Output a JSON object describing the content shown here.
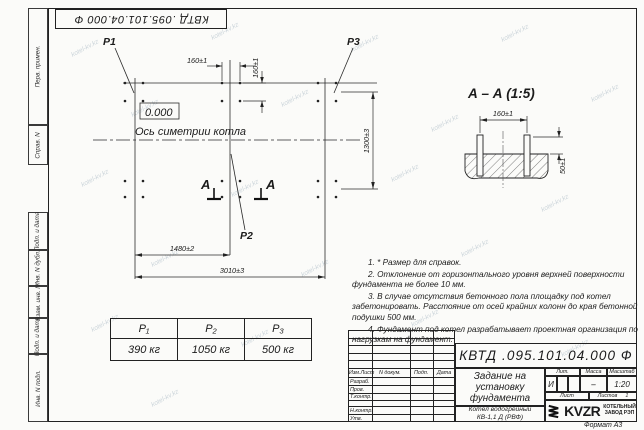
{
  "watermark": {
    "text": "kotel-kv.kz"
  },
  "frame": {
    "margin_labels": [
      "Перв. примен.",
      "Справ. N",
      "Подп. и дата",
      "Инв. N дубл.",
      "Взам. инв. N",
      "Подп. и дата",
      "Инв. N подл."
    ],
    "format_label": "Формат А3"
  },
  "plan": {
    "p1": "Р1",
    "p2": "Р2",
    "p3": "Р3",
    "elevation": "0.000",
    "axis_label": "Ось симетрии котла",
    "section_letter": "А",
    "dim_bolt_x": "160±1",
    "dim_bolt_y": "160±1",
    "dim_1480": "1480±2",
    "dim_3010": "3010±3",
    "dim_1300": "1300±3"
  },
  "section_view": {
    "title": "А – А (1:5)",
    "dim_160": "160±1",
    "dim_50": "50±1"
  },
  "notes": [
    "1. * Размер для справок.",
    "2. Отклонение от горизонтального уровня верхней поверхности фундамента не более 10 мм.",
    "3. В случае отсутствия бетонного пола площадку под котел забетонировать. Расстояние от осей крайних колонн до края бетонной подушки 500 мм.",
    "4. Фундамент под котел разрабатывает проектная организация по нагрузкам на фундамент."
  ],
  "load_table": {
    "headers": [
      "Р₁",
      "Р₂",
      "Р₃"
    ],
    "values": [
      "390 кг",
      "1050 кг",
      "500 кг"
    ]
  },
  "title_block": {
    "designation": "КВТД .095.101.04.000 Ф",
    "doc_title_1": "Задание на",
    "doc_title_2": "установку",
    "doc_title_3": "фундамента",
    "product_1": "Котел водогрейный",
    "product_2": "КВ-1,1 Д (РВФ)",
    "col_izm": "Изм.Лист",
    "col_doc": "N докум.",
    "col_podp": "Подп.",
    "col_data": "Дата",
    "row_razrab": "Разраб.",
    "row_prov": "Пров.",
    "row_tkontr": "Т.контр.",
    "row_nkontr": "Н.контр.",
    "row_utv": "Утв.",
    "lit_label": "Лит.",
    "mass_label": "Масса",
    "scale_label": "Масштаб",
    "lit_value": "И",
    "mass_value": "–",
    "scale_value": "1:20",
    "sheet_label": "Лист",
    "sheets_label": "Листов",
    "sheets_value": "1",
    "logo_text": "KVZR",
    "logo_cap_1": "КОТЕЛЬНЫЙ",
    "logo_cap_2": "ЗАВОД РЭП"
  }
}
